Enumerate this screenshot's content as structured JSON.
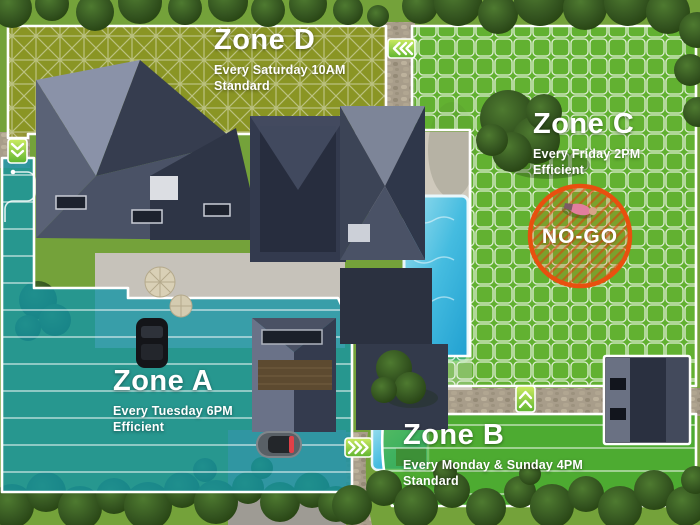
{
  "map": {
    "zones": [
      {
        "id": "zone-d",
        "name": "Zone D",
        "schedule": "Every Saturday 10AM",
        "mode": "Standard",
        "accent": "#8f9220"
      },
      {
        "id": "zone-c",
        "name": "Zone C",
        "schedule": "Every Friday 2PM",
        "mode": "Efficient",
        "accent": "#57bb2c"
      },
      {
        "id": "zone-a",
        "name": "Zone A",
        "schedule": "Every Tuesday 6PM",
        "mode": "Efficient",
        "accent": "#1495a5"
      },
      {
        "id": "zone-b",
        "name": "Zone B",
        "schedule": "Every Monday & Sunday 4PM",
        "mode": "Standard",
        "accent": "#3fae2e"
      }
    ],
    "no_go_zone": {
      "label": "NO-GO",
      "color": "#e8500f"
    }
  }
}
